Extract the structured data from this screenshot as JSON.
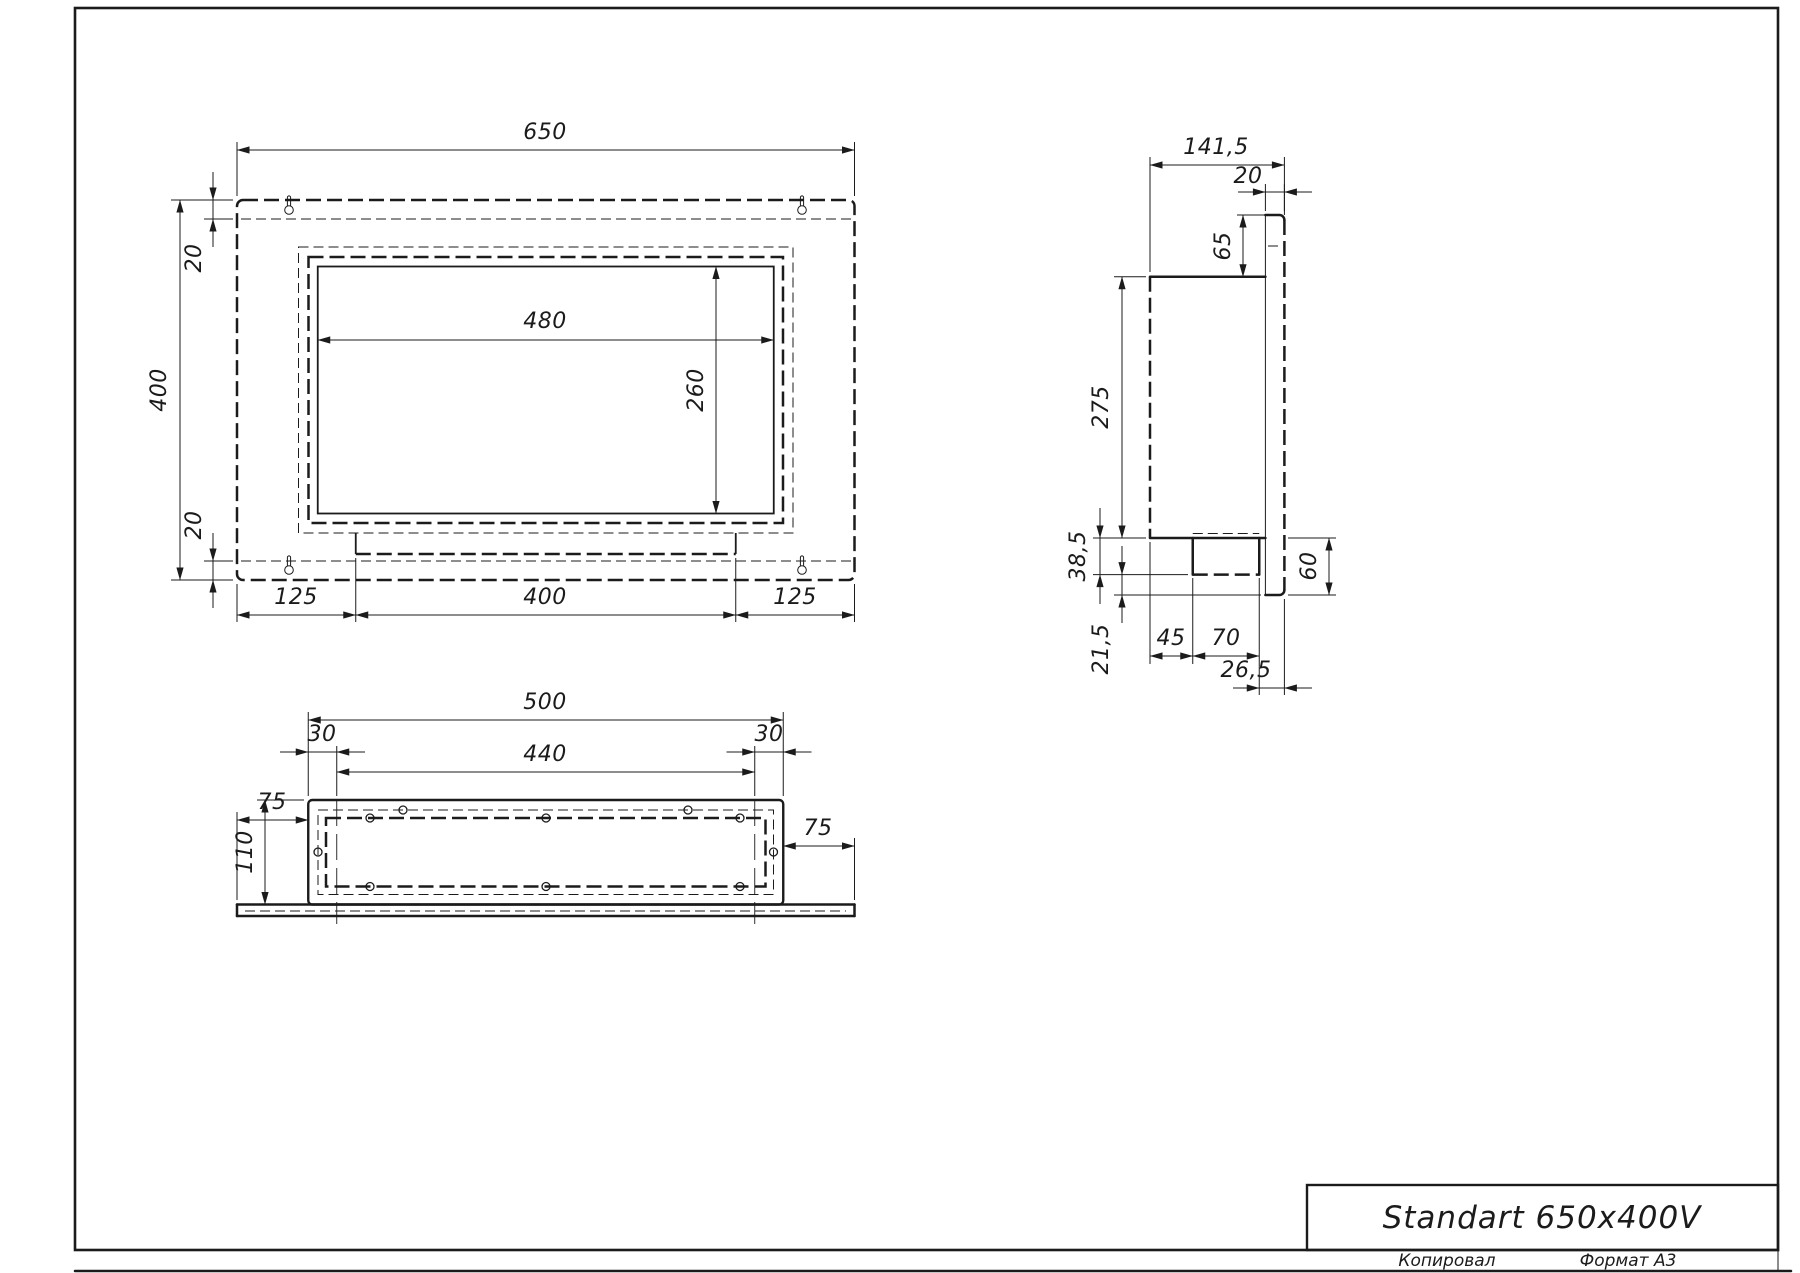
{
  "front": {
    "width": "650",
    "height": "400",
    "top_offset": "20",
    "bottom_offset": "20",
    "window_width": "480",
    "window_height": "260",
    "margin_left": "125",
    "bracket_width": "400",
    "margin_right": "125"
  },
  "side": {
    "depth": "141,5",
    "panel_thickness": "20",
    "top_overhang": "65",
    "body_height": "275",
    "box_depth": "38,5",
    "box_clearance": "21,5",
    "bottom_overhang": "60",
    "box_offset": "45",
    "box_width": "70",
    "back_clearance": "26,5"
  },
  "bottom": {
    "body_width": "500",
    "tab_offset_left": "30",
    "tab_offset_right": "30",
    "tab_span": "440",
    "flange_left": "75",
    "body_depth": "110",
    "flange_right": "75"
  },
  "title_block": {
    "title": "Standart 650x400V",
    "copied_by_label": "Копировал",
    "format_label": "Формат А3"
  }
}
